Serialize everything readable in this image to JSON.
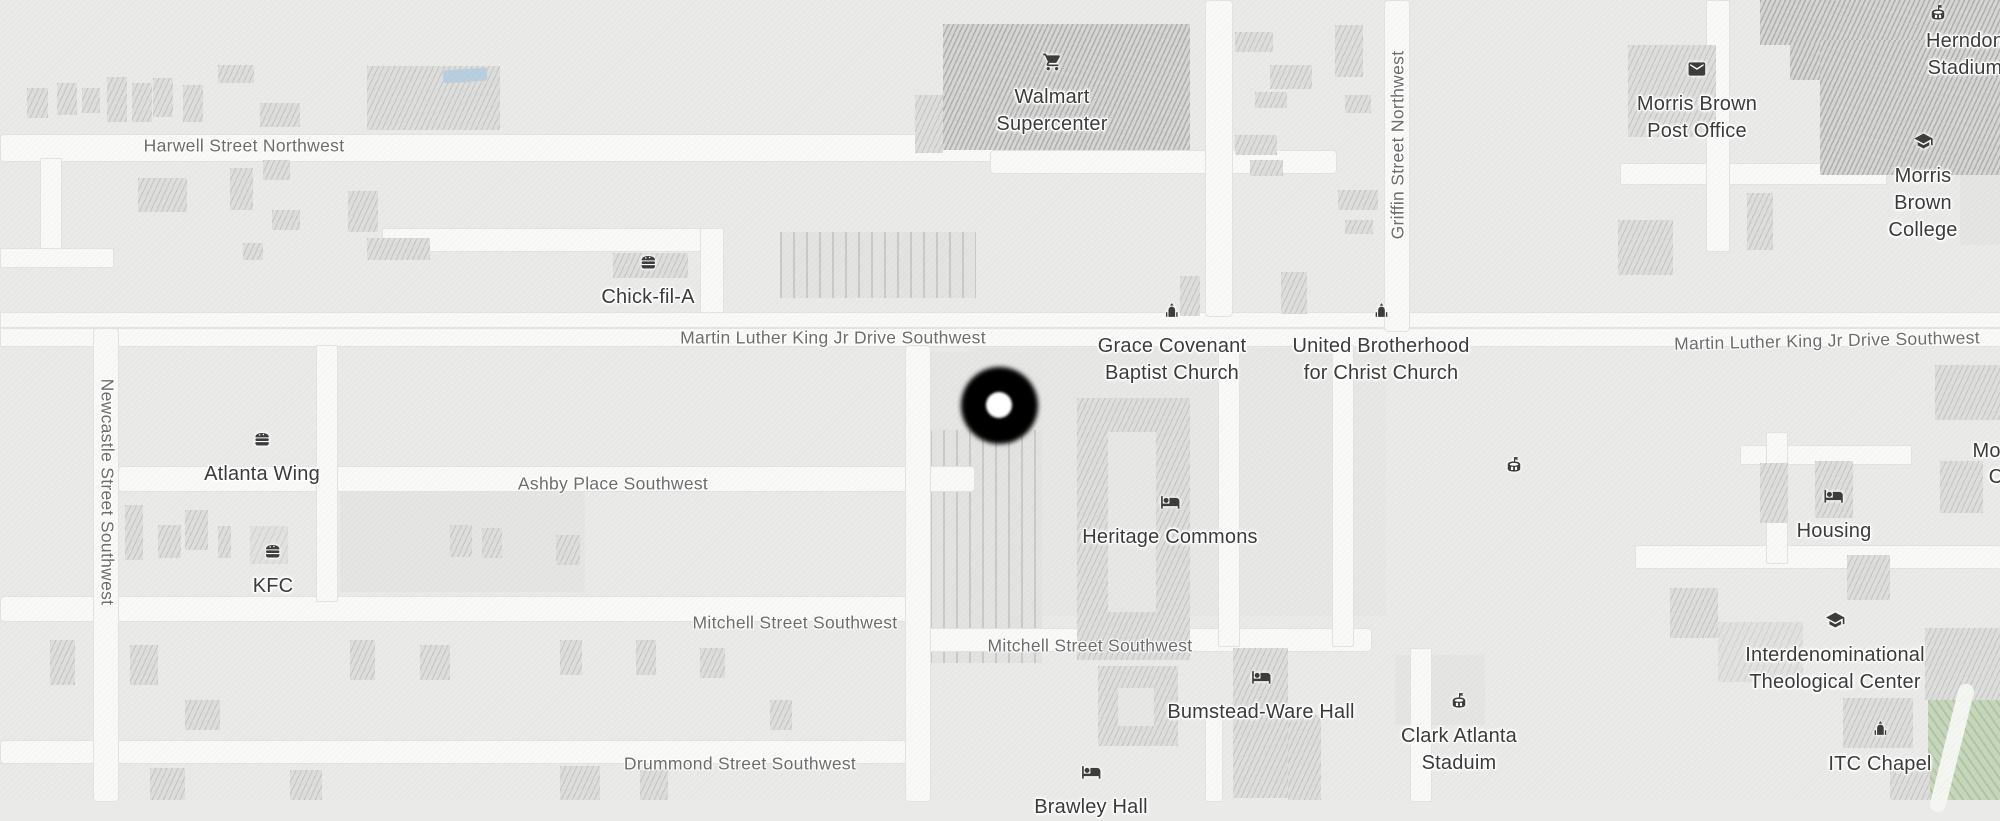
{
  "map": {
    "colors": {
      "background": "#eaeae8",
      "road": "#f9f9f7",
      "building": "#dededc",
      "park": "#c7d7bc",
      "pool": "#b9cfdf",
      "poi_text": "#3b3b3b",
      "street_text": "#6d6d6d",
      "marker": "#000000"
    }
  },
  "streets": {
    "harwell": {
      "name": "Harwell Street Northwest"
    },
    "mlk_west": {
      "name": "Martin Luther King Jr Drive Southwest"
    },
    "mlk_east": {
      "name": "Martin Luther King Jr Drive Southwest"
    },
    "griffin": {
      "name": "Griffin Street Northwest"
    },
    "newcastle": {
      "name": "Newcastle Street Southwest"
    },
    "ashby": {
      "name": "Ashby Place Southwest"
    },
    "mitchell_west": {
      "name": "Mitchell Street Southwest"
    },
    "mitchell_east": {
      "name": "Mitchell Street Southwest"
    },
    "drummond": {
      "name": "Drummond Street Southwest"
    }
  },
  "pois": {
    "walmart": {
      "name": "Walmart\nSupercenter",
      "icon": "shopping-cart"
    },
    "herndon_stadium": {
      "name": "Herndon Stadium",
      "icon": "stadium"
    },
    "morris_brown_post_office": {
      "name": "Morris Brown\nPost Office",
      "icon": "envelope"
    },
    "morris_brown_college": {
      "name": "Morris Brown\nCollege",
      "icon": "graduation-cap"
    },
    "chick_fil_a": {
      "name": "Chick-fil-A",
      "icon": "fast-food"
    },
    "grace_covenant": {
      "name": "Grace Covenant\nBaptist Church",
      "icon": "church"
    },
    "united_brotherhood": {
      "name": "United Brotherhood\nfor Christ Church",
      "icon": "church"
    },
    "atlanta_wing": {
      "name": "Atlanta Wing",
      "icon": "fast-food"
    },
    "kfc": {
      "name": "KFC",
      "icon": "fast-food"
    },
    "heritage_commons": {
      "name": "Heritage Commons",
      "icon": "bed"
    },
    "housing": {
      "name": "Housing",
      "icon": "bed"
    },
    "bumstead_ware": {
      "name": "Bumstead-Ware Hall",
      "icon": "bed"
    },
    "clark_atlanta_stadium": {
      "name": "Clark Atlanta\nStaduim",
      "icon": "stadium"
    },
    "itc": {
      "name": "Interdenominational\nTheological Center",
      "icon": "graduation-cap"
    },
    "itc_chapel": {
      "name": "ITC Chapel",
      "icon": "church"
    },
    "brawley_hall": {
      "name": "Brawley Hall",
      "icon": "bed"
    },
    "edge_partial": {
      "line1": "Mor",
      "line2": "C"
    }
  }
}
